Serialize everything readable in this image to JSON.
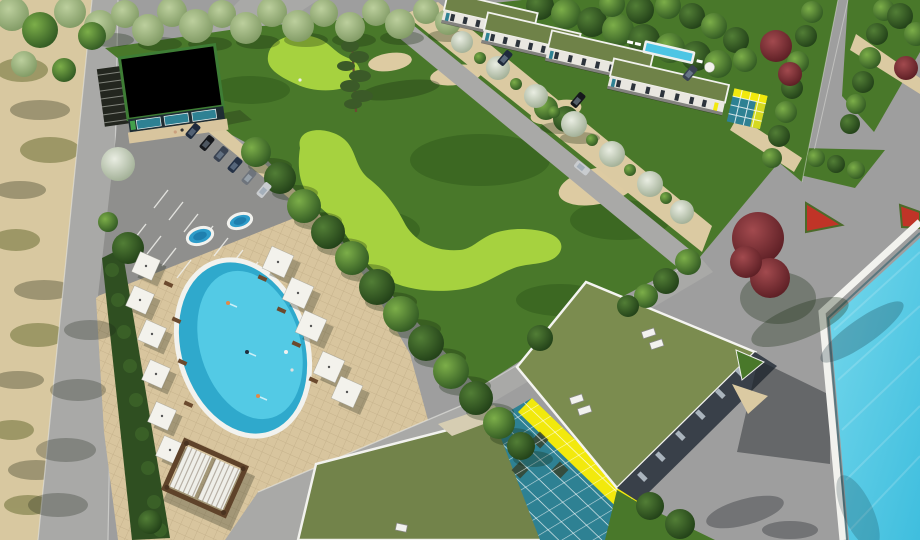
{
  "canvas": {
    "width": 920,
    "height": 540
  },
  "colors": {
    "plaza": "#9e9e9e",
    "road": "#a9a9a7",
    "curb": "#efefec",
    "sand_dune": "#d8c8a0",
    "dune_scrub": "#8f8c58",
    "sand_path": "#dbcaa2",
    "lawn": "#49782a",
    "fairway": "#a6d23f",
    "bunker": "#ddcba2",
    "paver": "#d8c59e",
    "hedge": "#2f4f21",
    "pool_water": "#4cc5e4",
    "pool_water_deep": "#2fa9cc",
    "pool_rim": "#f2f2ee",
    "spa_water": "#2e9cc9",
    "roof_green": "#7b8c4f",
    "roof_green_dark": "#72834a",
    "roof_town": "#6f8248",
    "roof_white": "#ececе7",
    "roof_trim": "#3e7d35",
    "facade_white": "#e9e7e0",
    "facade_dark": "#394049",
    "glass_teal": "#2e8193",
    "glass_yellow": "#f2e90d",
    "umbrella": "#f3f2ec",
    "lounger": "#6b4a2e",
    "pergola_frame": "#5f432a",
    "pergola_slat": "#efefe9",
    "terrace": "#d6cdb2",
    "flower_red": "#c03427",
    "red_tree": "#7d2832",
    "tree_dark": "#2f5220",
    "tree_light": "#6da13f",
    "willow": "#a3ba88",
    "blossom": "#ccd5c3",
    "car_navy": "#1e2a3c",
    "car_black": "#16181c",
    "car_slate": "#3a4352",
    "car_navy2": "#253246",
    "car_gray": "#6e747c",
    "car_white": "#c9cccf",
    "shadow": "rgba(25,30,18,0.35)"
  },
  "scene": {
    "type": "aerial-3d-architectural-render",
    "golf_course": {
      "fairways": 2,
      "bunkers": 3,
      "sand_patches": 1,
      "pine_trees": 1
    },
    "oval_pool_area": {
      "pools": 1,
      "spa_pools": 2,
      "umbrellas": 11,
      "loungers": 8,
      "pergolas": 1,
      "swimmers": 5
    },
    "parking": {
      "cars": 6,
      "stall_line_rows": 2,
      "blossom_trees": 1
    },
    "clubhouse": {
      "roof": "white",
      "trim": "green",
      "glass": "teal",
      "pergola_side": "northwest"
    },
    "townhouses": {
      "buildings": 4,
      "roofs": "green",
      "private_pool": 1,
      "street_cars": 4,
      "glass_pavilion": 1
    },
    "wellness_building": {
      "roof_volumes": 2,
      "atrium_glass": [
        "yellow",
        "teal"
      ],
      "roof_vent_pairs": 3
    },
    "main_pool": {
      "shape": "rectangular",
      "rim": "white"
    },
    "landscape": {
      "red_trees": 6,
      "flower_bed_triangles": 2,
      "willow_row": true,
      "sand_dunes_left": true,
      "tree_alleys_top_right": 2
    }
  }
}
